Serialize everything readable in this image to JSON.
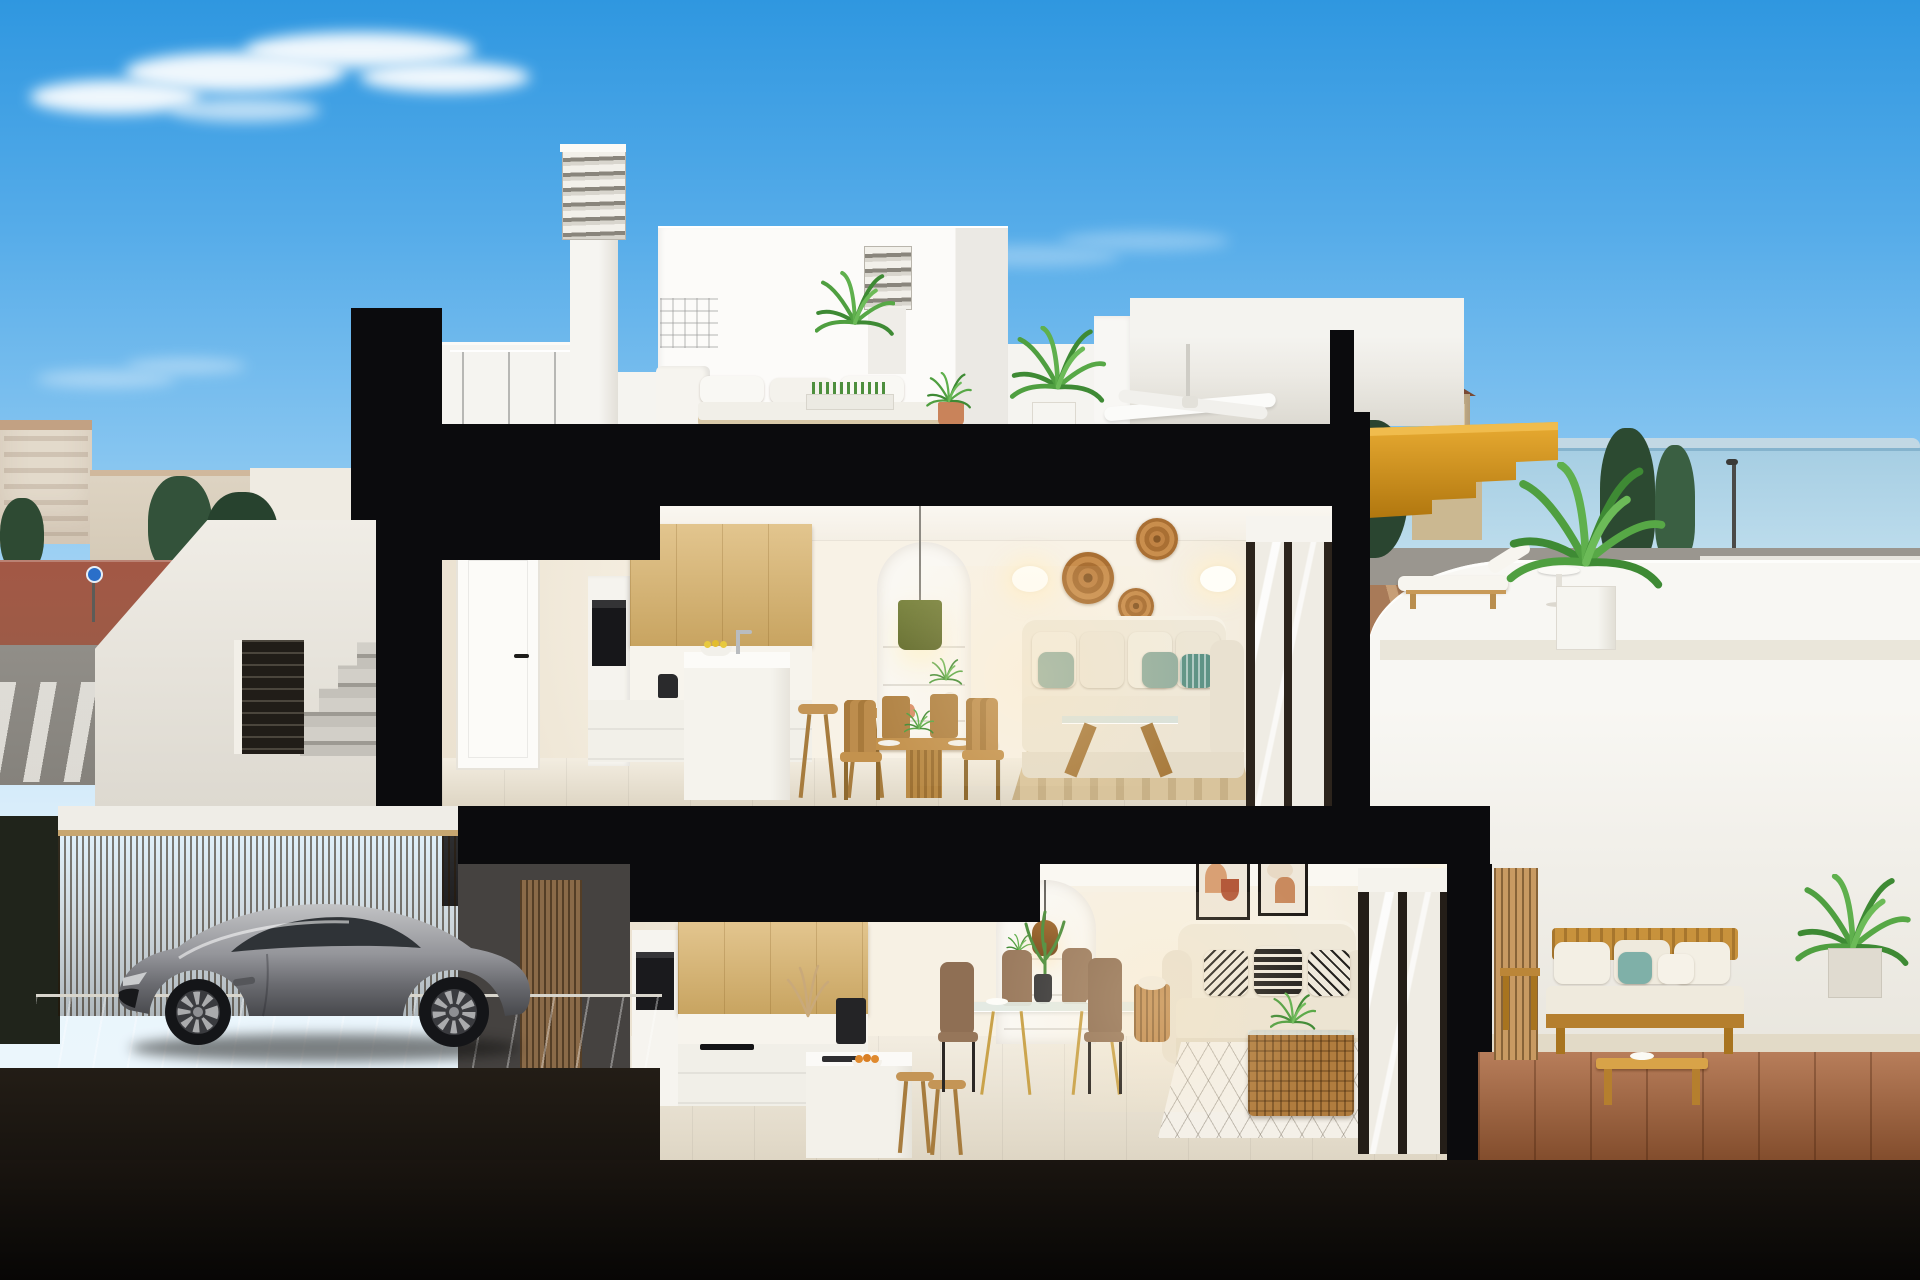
{
  "meta": {
    "kind": "3d-architectural-cross-section-render",
    "setting": "Cut-away section of a modern two-storey Mediterranean villa under a blue sky: rooftop terrace, upper and lower open-plan living floors, side stair entrance and carport with a silver sports coupe"
  },
  "palette": {
    "sky_top": "#2f97e0",
    "sky_horizon": "#d6ecfa",
    "cut_black": "#0b0b0d",
    "wall_white": "#f5f4f0",
    "interior_cream": "#f3ecdf",
    "oak_cabinet": "#d9b269",
    "stair_timber": "#cf9125",
    "fence_timber": "#9d7c50",
    "car_silver": "#9b9b9e",
    "sea": "#a6cee3",
    "palm_green": "#4f9f40",
    "sofa_cream": "#ece4d3",
    "cushion_sage": "#96b0a0",
    "cushion_teal": "#5f9486",
    "rattan": "#c08344",
    "terracotta_floor": "#a86136",
    "street_red": "#a0523d",
    "rug_jute": "#d9c49c",
    "concrete": "#c6c2b8",
    "wood_dining": "#c3924e"
  },
  "scene": {
    "sky": {
      "clouds": 3,
      "description": "wispy white cloud upper left, faint wisps mid-right and lower left"
    },
    "background_left": "low-rise Mediterranean town, green trees, red paved promenade, grey road with zebra crossing, blue roundabout sign",
    "background_right": "sea horizon with watchtower, dark cypress trees, esplanade road with street lamps, ochre dirt field with paths",
    "rooftop": {
      "items": [
        "louvered chimney tall",
        "louvered chimney short",
        "white roof volumes",
        "white outdoor lounge sofa with cushions",
        "planter tray table",
        "terracotta potted plant",
        "potted palm",
        "leafy plant",
        "covered canopy with ceiling fan",
        "glass balustrade posts",
        "golden timber stair cut"
      ]
    },
    "upper_floor": {
      "rooms": [
        "hallway with white door",
        "kitchen: oak wall cabinets, oven column, white island with faucet and lemon bowl, two timber bar stools",
        "dining nook: round timber table, four timber chairs, plant centerpiece",
        "arched shelf niche with olive-green pendant lamp, terracotta vases, trailing plant",
        "living room: cream sofa with sage and teal cushions, glass trestle coffee table, striped jute rug",
        "sliding glass door with roller blind"
      ],
      "wall_decor": [
        "oval wall sconce left",
        "oval wall sconce right",
        "three woven rattan discs"
      ]
    },
    "upper_terrace": {
      "items": [
        "timber sun lounger with white pad",
        "round white side table",
        "potted palm in white planter",
        "curved white parapet overlooking the sea"
      ]
    },
    "lower_floor": {
      "rooms": [
        "kitchen: oak cabinets, black coffee machine, dried-grass vase, white peninsula with sink and orange bowl, two timber stools",
        "glass dining table with gold legs, four tan chairs, tall green centerpiece",
        "arched niche with amber pendant lamp and small plants",
        "living room: cream loveseat with monochrome patterned cushions, woven rattan coffee table with plant, diamond-pattern rug, rattan basket with throw",
        "two abstract framed artworks",
        "oval wall sconce",
        "sliding glass door"
      ]
    },
    "lower_terrace": {
      "items": [
        "timber slat privacy panel",
        "timber outdoor sofa with white and teal cushions",
        "timber coffee table",
        "timber side table",
        "corner potted plant",
        "terracotta tile floor"
      ]
    },
    "entrance_and_carport": {
      "items": [
        "white stair parapet with diagonal",
        "concrete steps",
        "dark louvered gate",
        "timber slat fence",
        "paved driveway",
        "silver sports coupe facing left",
        "dark hedge wall"
      ]
    }
  }
}
